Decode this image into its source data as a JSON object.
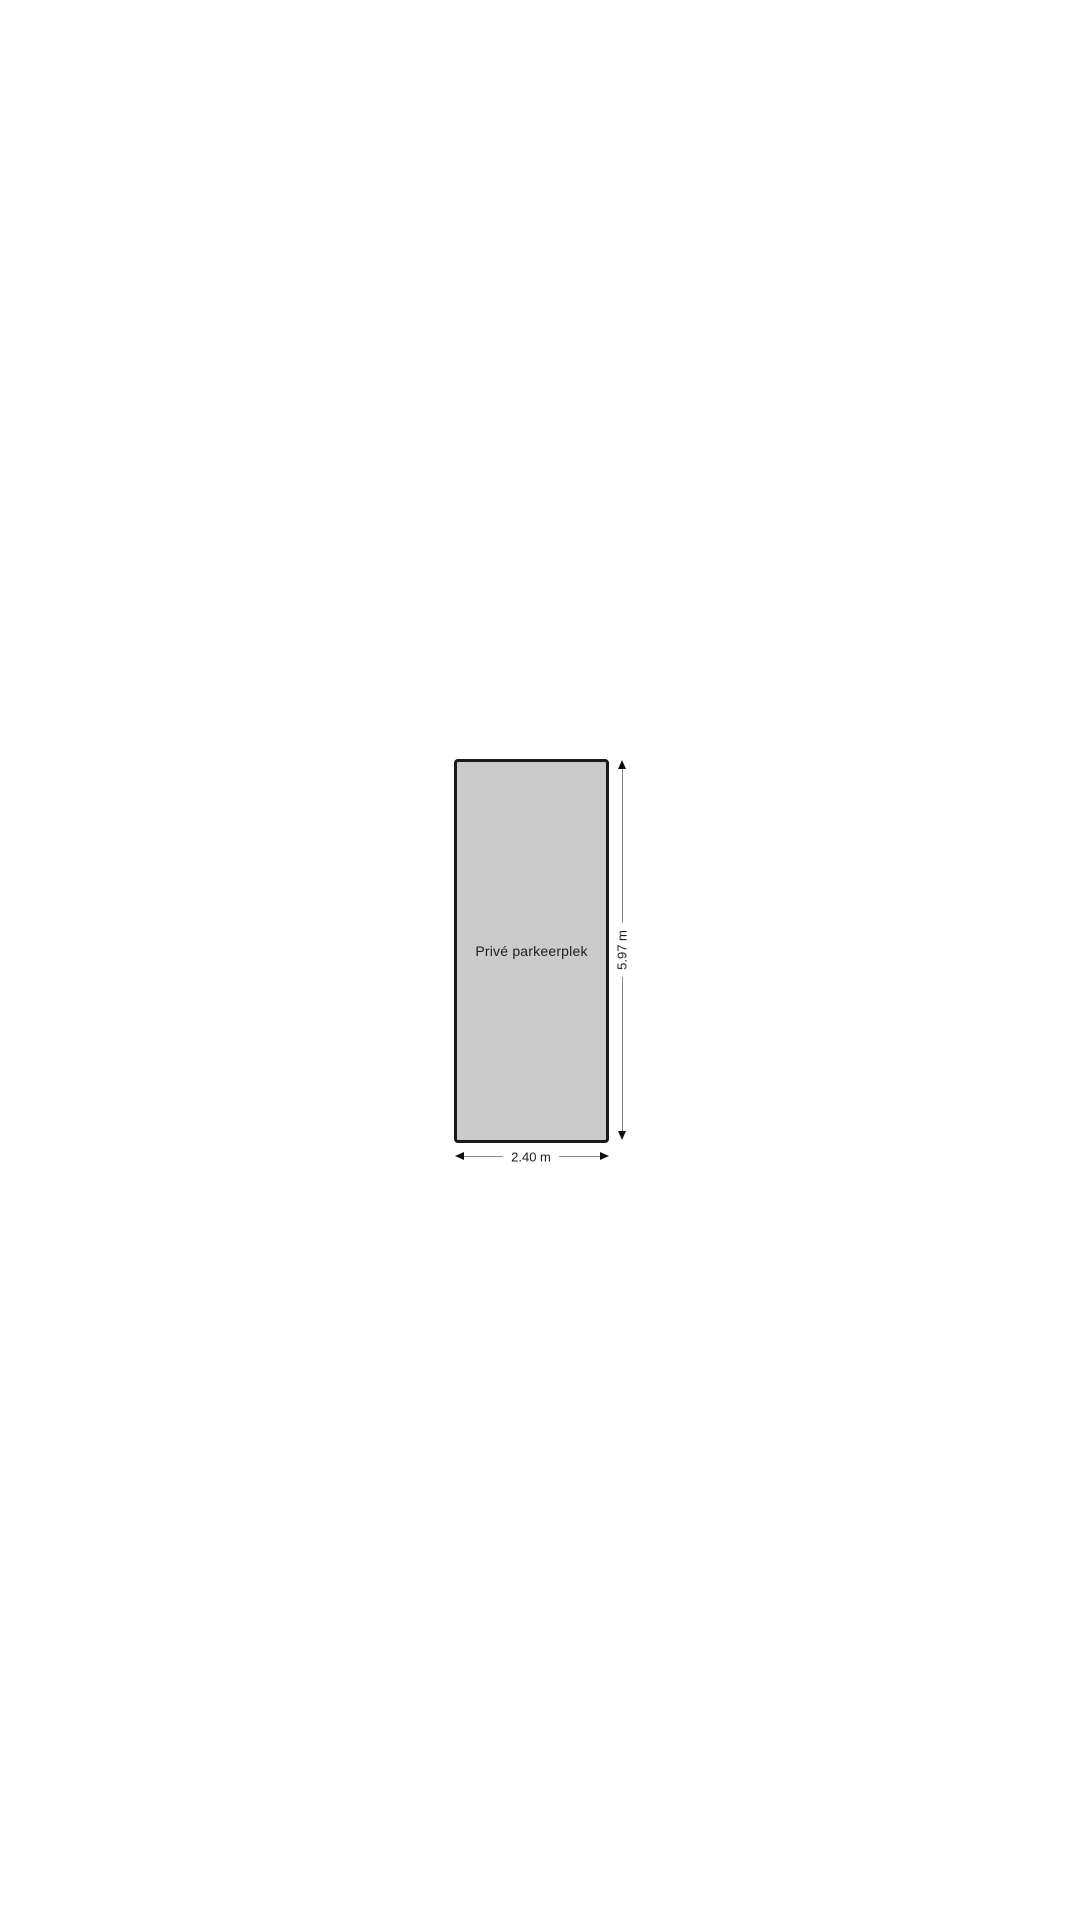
{
  "floorplan": {
    "space": {
      "label": "Privé parkeerplek",
      "fill_color": "#cbcbcb",
      "border_color": "#1a1a1a"
    },
    "dimensions": {
      "height_label": "5.97 m",
      "width_label": "2.40 m",
      "line_color": "#8a8a8a",
      "arrow_color": "#111111"
    },
    "text_color": "#1d1d1d",
    "background_color": "#ffffff"
  }
}
